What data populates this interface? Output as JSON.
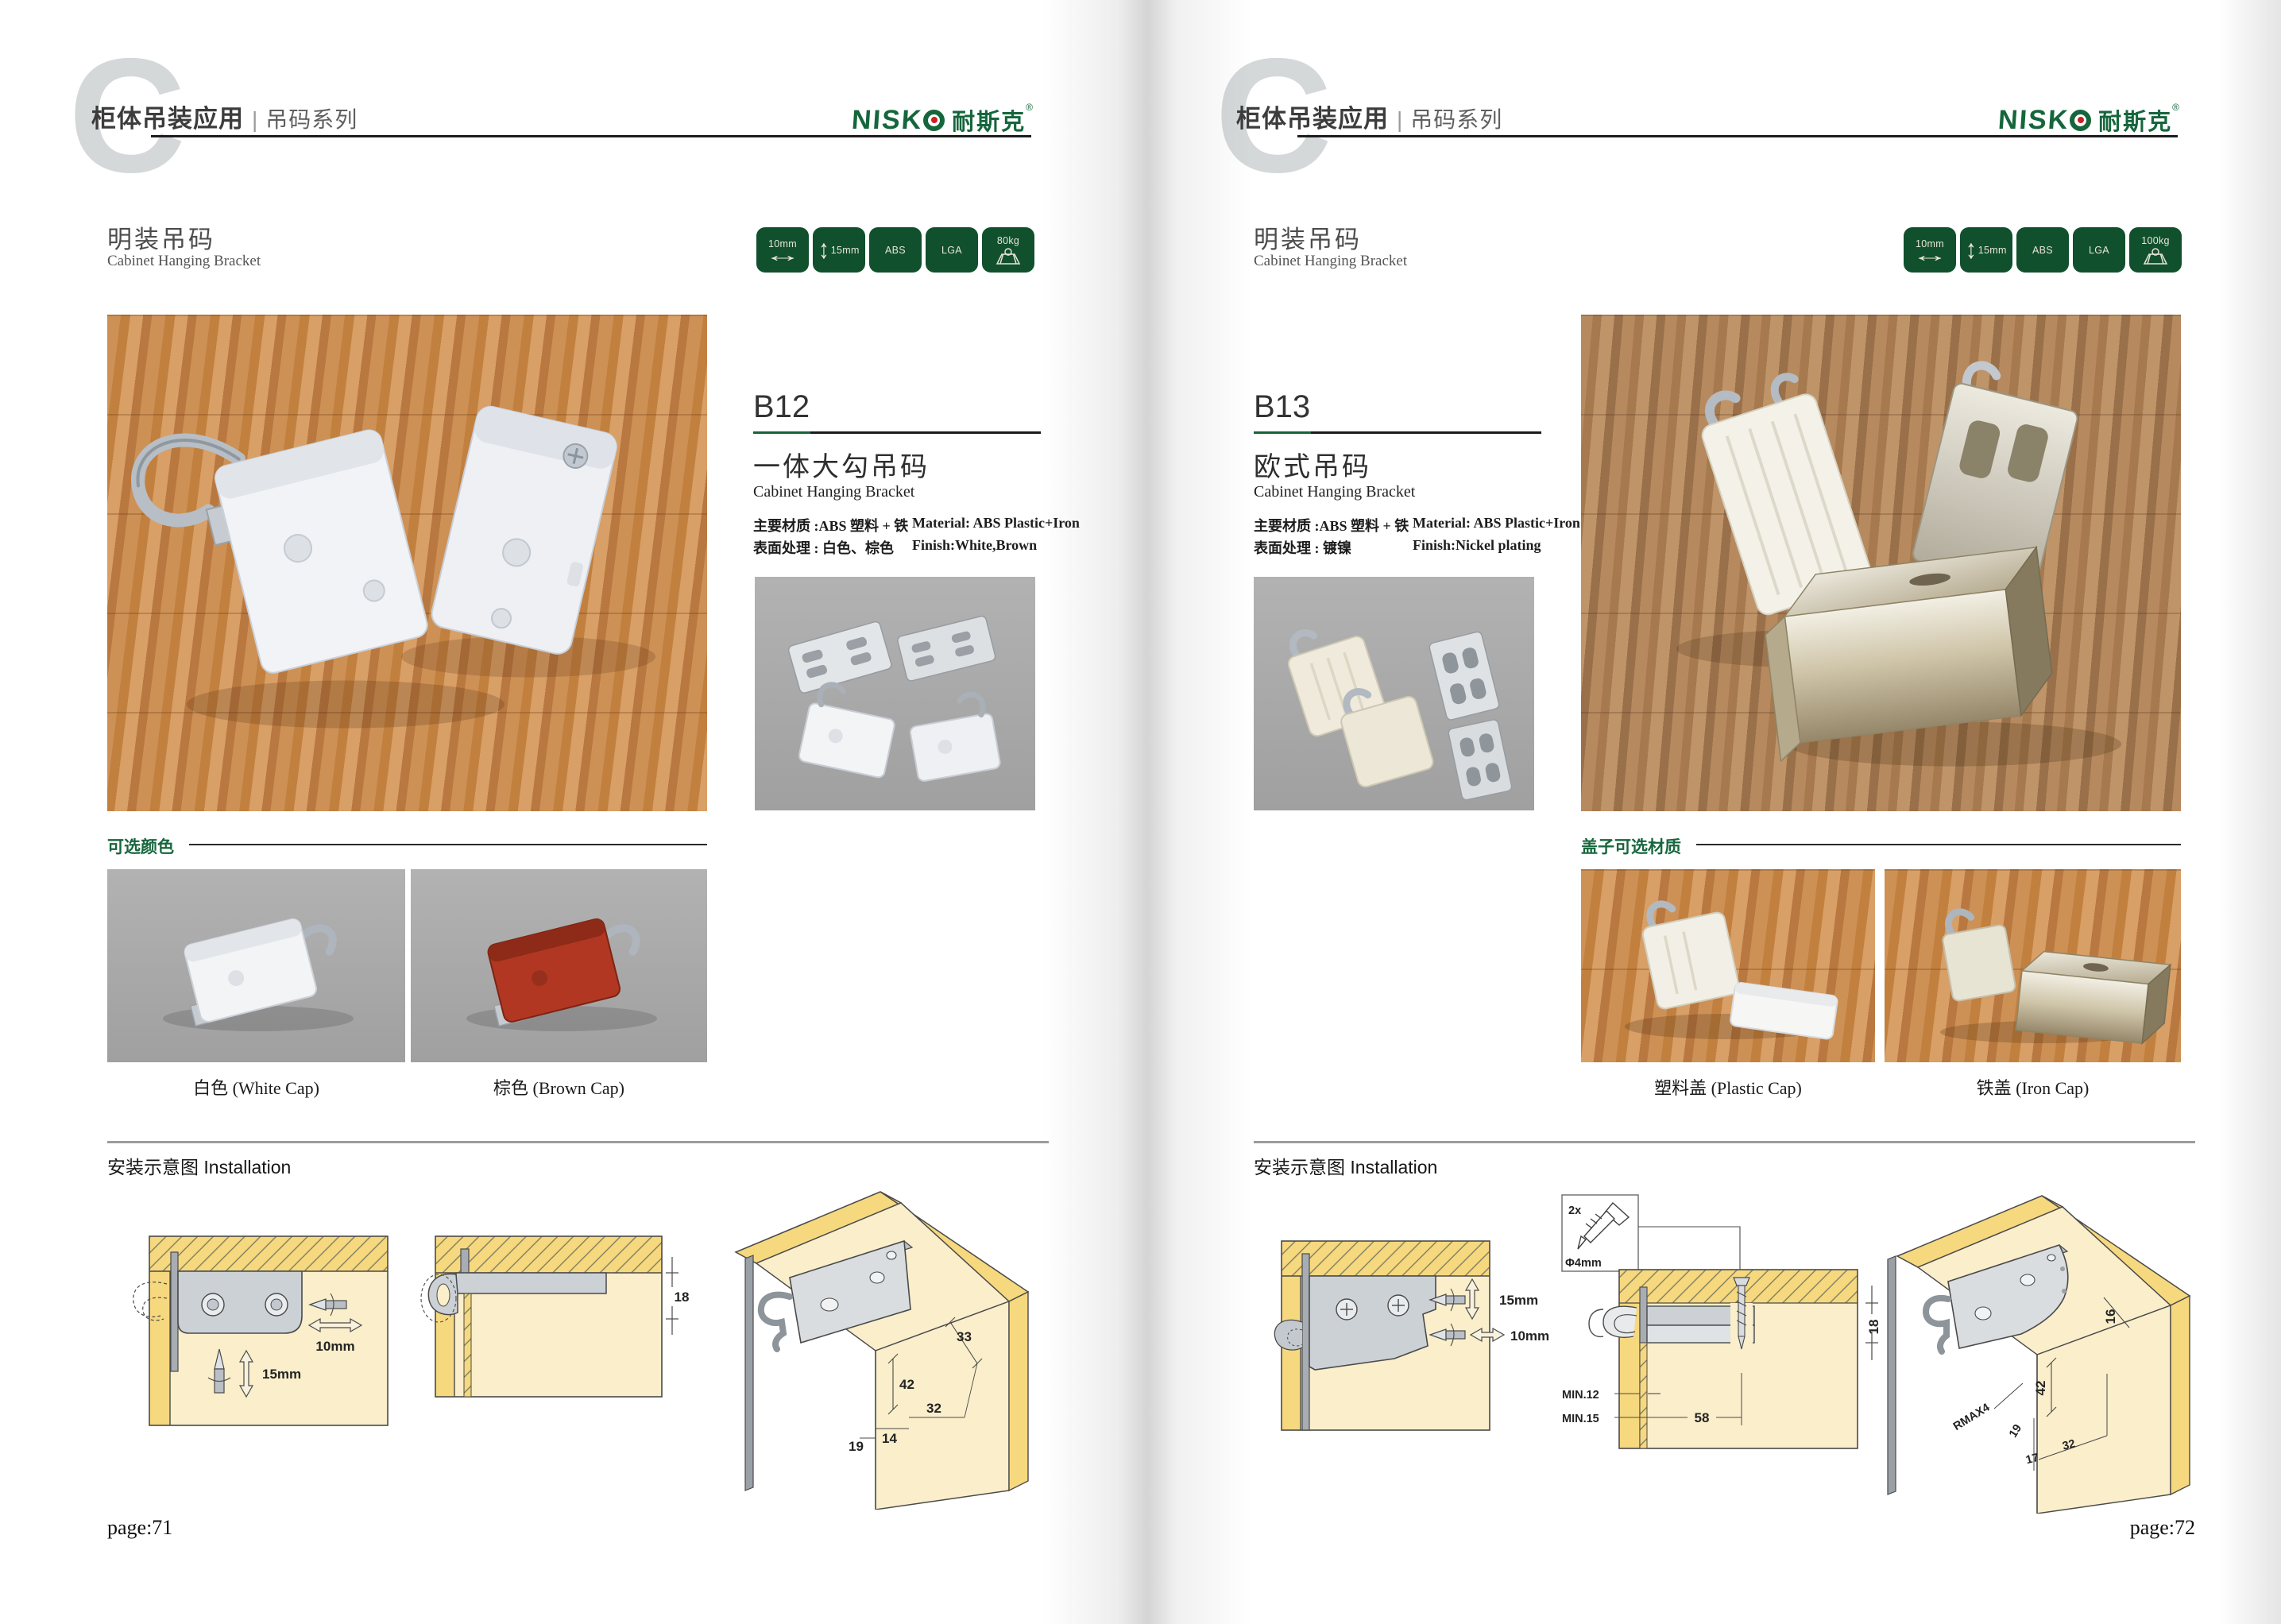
{
  "brand": {
    "logo_latin": "NISK",
    "logo_cn": "耐斯克",
    "logo_reg": "®",
    "logo_o_icon": "ring-with-red-dot"
  },
  "header": {
    "watermark": "C",
    "title_bold": "柜体吊装应用",
    "divider": "|",
    "title_light": "吊码系列"
  },
  "glyphs": {
    "h_arrow": "↔",
    "v_arrow": "↕"
  },
  "colors": {
    "brand_green": "#15663c",
    "badge_green": "#11502d",
    "diagram_cream": "#faeecb",
    "diagram_yellow": "#f6d87e"
  },
  "left_page": {
    "page_number": "page:71",
    "section_title_cn": "明装吊码",
    "section_title_en": "Cabinet Hanging Bracket",
    "badges": [
      {
        "label": "10mm",
        "icon": "horizontal-double-arrow"
      },
      {
        "label": "15mm",
        "icon": "vertical-double-arrow"
      },
      {
        "label": "ABS"
      },
      {
        "label": "LGA"
      },
      {
        "label": "80kg",
        "icon": "load-capacity"
      }
    ],
    "product": {
      "code": "B12",
      "name_cn": "一体大勾吊码",
      "name_en": "Cabinet Hanging Bracket",
      "material_cn": "主要材质 :ABS 塑料 + 铁",
      "material_en": "Material: ABS Plastic+Iron",
      "finish_cn": "表面处理 : 白色、棕色",
      "finish_en": "Finish:White,Brown"
    },
    "options": {
      "title": "可选颜色",
      "captions": [
        "白色 (White Cap)",
        "棕色 (Brown Cap)"
      ]
    },
    "installation": {
      "title": "安装示意图 Installation",
      "d1": {
        "horiz": "10mm",
        "vert": "15mm"
      },
      "d2": {
        "height": "18"
      },
      "d3": {
        "dim33": "33",
        "dim42": "42",
        "dim32": "32",
        "dim14": "14",
        "dim19": "19"
      }
    }
  },
  "right_page": {
    "page_number": "page:72",
    "section_title_cn": "明装吊码",
    "section_title_en": "Cabinet Hanging Bracket",
    "badges": [
      {
        "label": "10mm",
        "icon": "horizontal-double-arrow"
      },
      {
        "label": "15mm",
        "icon": "vertical-double-arrow"
      },
      {
        "label": "ABS"
      },
      {
        "label": "LGA"
      },
      {
        "label": "100kg",
        "icon": "load-capacity"
      }
    ],
    "product": {
      "code": "B13",
      "name_cn": "欧式吊码",
      "name_en": "Cabinet Hanging Bracket",
      "material_cn": "主要材质 :ABS 塑料 + 铁",
      "material_en": "Material: ABS Plastic+Iron",
      "finish_cn": "表面处理 : 镀镍",
      "finish_en": "Finish:Nickel plating"
    },
    "options": {
      "title": "盖子可选材质",
      "captions": [
        "塑料盖 (Plastic Cap)",
        "铁盖 (Iron Cap)"
      ]
    },
    "installation": {
      "title": "安装示意图 Installation",
      "d1": {
        "vert": "15mm",
        "horiz": "10mm"
      },
      "d2": {
        "qty": "2x",
        "dia": "Φ4mm",
        "height": "18",
        "min1": "MIN.12",
        "min2": "MIN.15",
        "width": "58"
      },
      "d3": {
        "dim16": "16",
        "dim42": "42",
        "rmax": "RMAX4",
        "dim19": "19",
        "dim17": "17",
        "dim32": "32"
      }
    }
  }
}
